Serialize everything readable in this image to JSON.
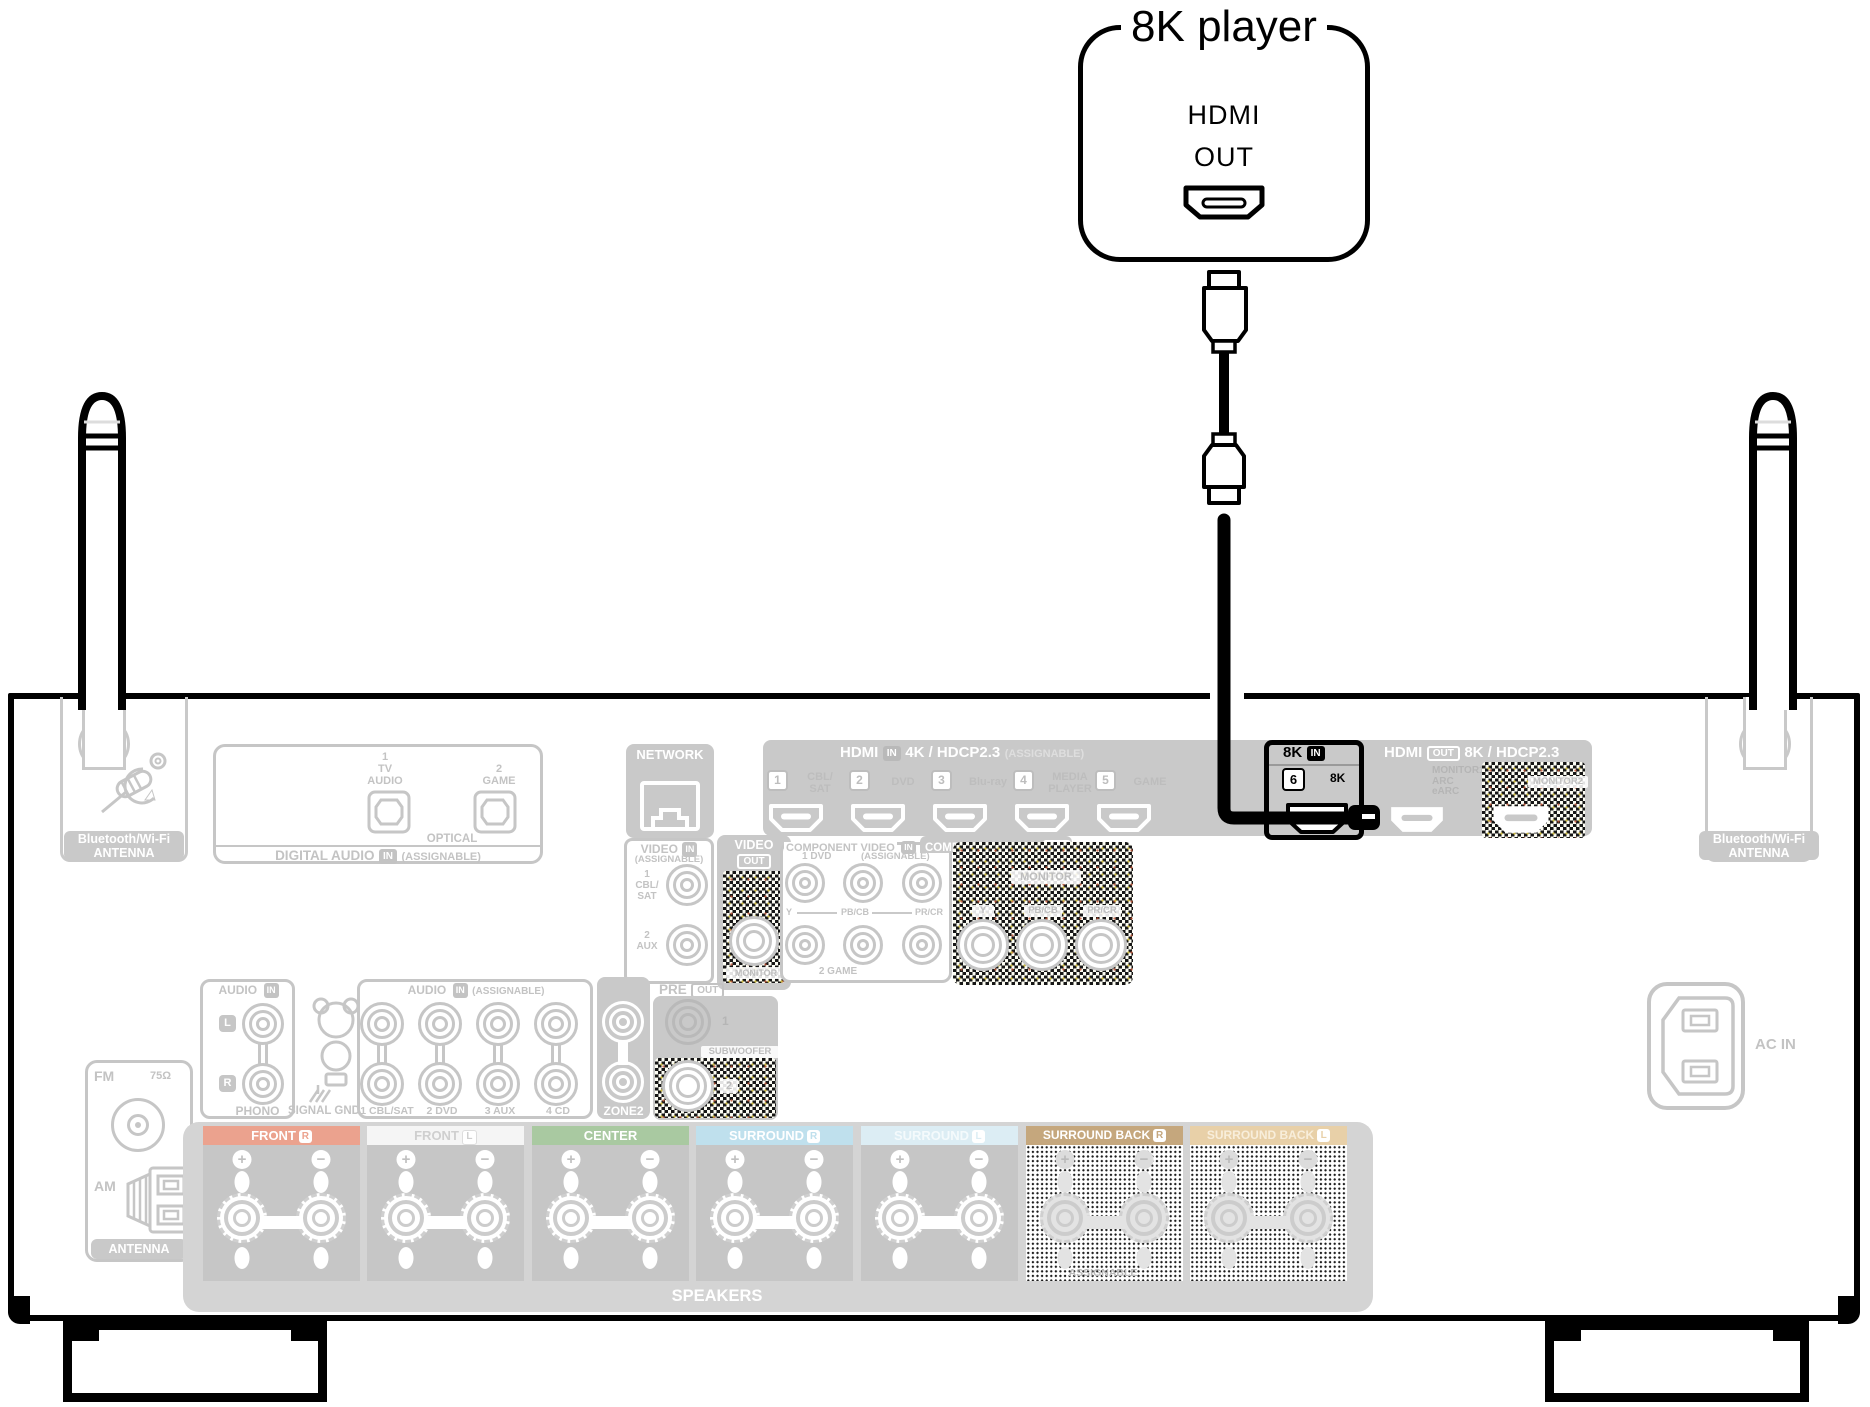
{
  "player": {
    "title": "8K player",
    "hdmi": "HDMI",
    "out": "OUT"
  },
  "receiver": {
    "bt_left": {
      "l1": "Bluetooth/Wi-Fi",
      "l2": "ANTENNA"
    },
    "bt_right": {
      "l1": "Bluetooth/Wi-Fi",
      "l2": "ANTENNA"
    },
    "digital_audio": {
      "title": "DIGITAL AUDIO",
      "badge": "IN",
      "assignable": "(ASSIGNABLE)",
      "p1n": "1",
      "p1a": "TV",
      "p1b": "AUDIO",
      "p2n": "2",
      "p2a": "GAME",
      "optical": "OPTICAL"
    },
    "network": {
      "title": "NETWORK"
    },
    "video_in": {
      "title": "VIDEO",
      "badge": "IN",
      "assignable": "(ASSIGNABLE)",
      "j1n": "1",
      "j1a": "CBL/",
      "j1b": "SAT",
      "j2n": "2",
      "j2a": "AUX"
    },
    "video_out": {
      "title": "VIDEO",
      "badge": "OUT",
      "monitor": "MONITOR"
    },
    "hdmi_in": {
      "title": "HDMI",
      "badge": "IN",
      "spec": "4K / HDCP2.3",
      "assignable": "(ASSIGNABLE)",
      "ports": [
        {
          "num": "1",
          "l1": "CBL/",
          "l2": "SAT"
        },
        {
          "num": "2",
          "l1": "DVD",
          "l2": ""
        },
        {
          "num": "3",
          "l1": "Blu-ray",
          "l2": ""
        },
        {
          "num": "4",
          "l1": "MEDIA",
          "l2": "PLAYER"
        },
        {
          "num": "5",
          "l1": "GAME",
          "l2": ""
        }
      ]
    },
    "hdmi_8k": {
      "title": "8K",
      "badge": "IN",
      "num": "6",
      "label": "8K"
    },
    "hdmi_out": {
      "title": "HDMI",
      "badge": "OUT",
      "spec": "8K / HDCP2.3",
      "m1a": "MONITOR1",
      "m1b": "ARC",
      "m1c": "eARC",
      "m2": "MONITOR2"
    },
    "comp_in": {
      "title": "COMPONENT VIDEO",
      "badge": "IN",
      "assignable": "(ASSIGNABLE)",
      "row1": "1 DVD",
      "y": "Y",
      "pb": "PB/CB",
      "pr": "PR/CR",
      "row2": "2 GAME"
    },
    "comp_out": {
      "title": "COMPONENT VIDEO",
      "badge": "OUT",
      "monitor": "MONITOR",
      "y": "Y",
      "pb": "PB/CB",
      "pr": "PR/CR"
    },
    "audio_phono": {
      "title": "AUDIO",
      "badge": "IN",
      "l": "L",
      "r": "R",
      "label": "PHONO"
    },
    "signal_gnd": {
      "label": "SIGNAL GND"
    },
    "audio_assign": {
      "title": "AUDIO",
      "badge": "IN",
      "assignable": "(ASSIGNABLE)",
      "c1": "1 CBL/SAT",
      "c2": "2 DVD",
      "c3": "3 AUX",
      "c4": "4 CD"
    },
    "zone2": {
      "label": "ZONE2"
    },
    "pre_out": {
      "title": "PRE",
      "badge": "OUT",
      "j1": "1",
      "sub": "SUBWOOFER",
      "j2": "2"
    },
    "tuner": {
      "fm": "FM",
      "ohm": "75Ω",
      "am": "AM",
      "antenna": "ANTENNA"
    },
    "ac_in": {
      "label": "AC IN"
    },
    "speakers": {
      "footer": "SPEAKERS",
      "assignable": "ASSIGNABLE",
      "blocks": [
        {
          "label": "FRONT",
          "ch": "R"
        },
        {
          "label": "FRONT",
          "ch": "L"
        },
        {
          "label": "CENTER",
          "ch": ""
        },
        {
          "label": "SURROUND",
          "ch": "R"
        },
        {
          "label": "SURROUND",
          "ch": "L"
        },
        {
          "label": "SURROUND BACK",
          "ch": "R"
        },
        {
          "label": "SURROUND BACK",
          "ch": "L"
        }
      ]
    }
  },
  "colors": {
    "highlight": "#000000",
    "panel_gray": "#c9c9c9",
    "label_gray": "#c3c3c3",
    "front_r": "#eba28e",
    "front_l": "#f5f5f5",
    "center": "#a9c9a1",
    "surround_r": "#bfe0ed",
    "surround_l": "#dcedf4",
    "surround_back_r": "#c5a77d",
    "surround_back_l": "#e8d0a8"
  }
}
